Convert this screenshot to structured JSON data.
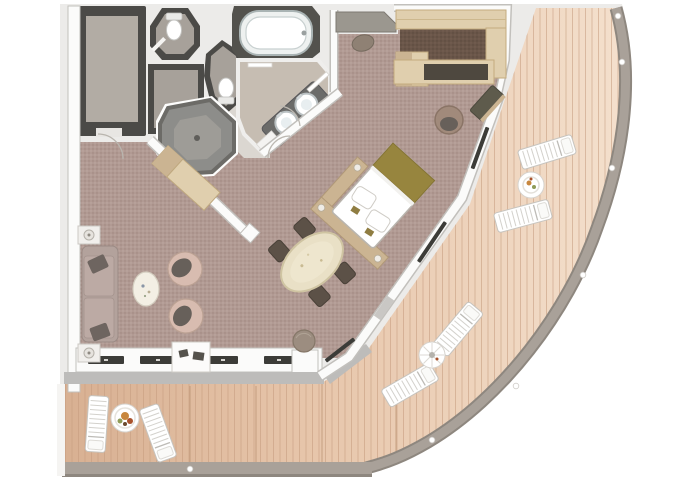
{
  "document": {
    "title": "Suite floor plan",
    "type": "architectural-floor-plan",
    "visible_text_labels": []
  },
  "colors": {
    "page_bg": "#ffffff",
    "mat": "#ecebe9",
    "wall_white": "#fbfbfa",
    "wall_stroke": "#c2c0bc",
    "wall_dark": "#4b4a47",
    "floor_closet": "#b2aca4",
    "floor_wc": "#a7a19a",
    "floor_bath": "#c6bdb2",
    "hall_floor": "#dbd7d1",
    "carpet": "#b19a93",
    "carpet_dot": "#8a6f67",
    "wardrobe_floor": "#6a5649",
    "wood_light": "#e0cfae",
    "wood_mid": "#cbb492",
    "deck_base": "#d8b092",
    "deck_light": "#f4e0cd",
    "deck_line": "#c49b7e",
    "railing": "#a9a199",
    "railing_edge": "#8e877f",
    "sill": "#bdbcba",
    "glazing": "#3c3c38",
    "sofa": "#b3a29c",
    "cushion_dark": "#6e6560",
    "armchair": "#d8bcb0",
    "seat_dark": "#67605a",
    "table_marble": "#e9e0c6",
    "chair_dark": "#5c5147",
    "pouf": "#9c8d80",
    "bed_white": "#ffffff",
    "bed_throw": "#97853e",
    "tub_surround": "#53524d",
    "vanity": "#6b6b69",
    "shower_outer": "#8d8d8a",
    "shower_inner": "#9e9c97",
    "lounger": "#ffffff",
    "food_orange": "#c8873e",
    "food_red": "#a9522c",
    "food_green": "#8f9b57"
  },
  "plan": {
    "rooms": [
      "walk-in-closet",
      "water-closet-1",
      "shower-room",
      "shower-stall",
      "water-closet-2",
      "bathtub-alcove",
      "bathroom",
      "entry-hall",
      "living-room",
      "dining-area",
      "bedroom",
      "walk-in-wardrobe",
      "side-balcony",
      "curved-wrap-balcony"
    ],
    "bathroom_fixtures": [
      "bathtub",
      "double-sink-vanity",
      "toilet",
      "toilet",
      "octagonal-shower-tray",
      "bath-mat",
      "towel-bar"
    ],
    "furniture": [
      "sofa",
      "throw-pillow",
      "throw-pillow",
      "end-table-with-lamp",
      "end-table-with-lamp",
      "armchair",
      "armchair",
      "coffee-table",
      "console-table",
      "tv-cabinet",
      "oval-dining-table",
      "dining-chair",
      "dining-chair",
      "dining-chair",
      "dining-chair",
      "round-pouf",
      "double-bed",
      "bed-platform-with-lamps",
      "luggage-bench",
      "oval-ottoman",
      "desk",
      "desk-chair",
      "window-bench"
    ],
    "balcony": {
      "sun_loungers": 6,
      "deck_tables": 3,
      "railing_stanchions": 7,
      "decks": [
        "side-balcony",
        "curved-wrap-balcony"
      ]
    }
  }
}
